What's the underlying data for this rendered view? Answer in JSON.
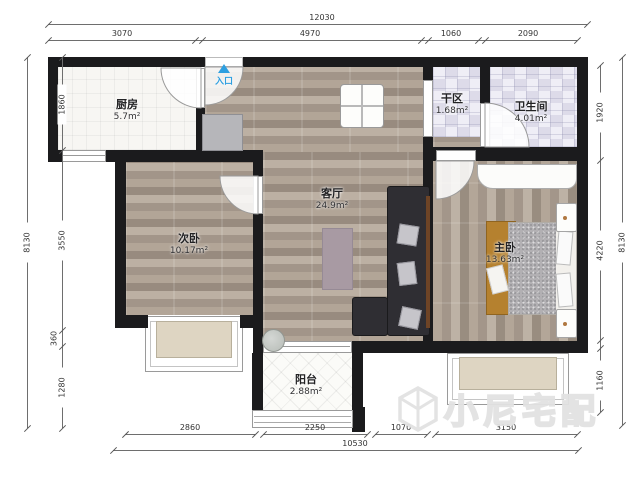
{
  "plan": {
    "entry_label": "入口",
    "rooms": {
      "kitchen": {
        "name": "厨房",
        "area": "5.7m²"
      },
      "dry_area": {
        "name": "干区",
        "area": "1.68m²"
      },
      "bathroom": {
        "name": "卫生间",
        "area": "4.01m²"
      },
      "living_room": {
        "name": "客厅",
        "area": "24.9m²"
      },
      "second_bedroom": {
        "name": "次卧",
        "area": "10.17m²"
      },
      "master_bedroom": {
        "name": "主卧",
        "area": "13.63m²"
      },
      "balcony": {
        "name": "阳台",
        "area": "2.88m²"
      }
    }
  },
  "dimensions": {
    "top_total": "12030",
    "top_segments": [
      "3070",
      "4970",
      "1060",
      "2090"
    ],
    "left_total": "8130",
    "left_segments": [
      "1860",
      "3550",
      "360",
      "1280"
    ],
    "right_total": "8130",
    "right_segments": [
      "1920",
      "4220",
      "1160"
    ],
    "bottom_segments": [
      "2860",
      "2250",
      "1070",
      "3150"
    ],
    "bottom_total": "10530"
  },
  "watermark": {
    "text": "小尼宅配"
  },
  "colors": {
    "wall": "#1b1b1d",
    "entry_accent": "#2e9fe0",
    "wood_floor": "#a89b8d",
    "tile": "#e6e6ef",
    "bay_window": "#ded5c2",
    "sofa": "#2f2e33",
    "master_rug": "#b5812f",
    "living_rug": "#a89aa3"
  }
}
